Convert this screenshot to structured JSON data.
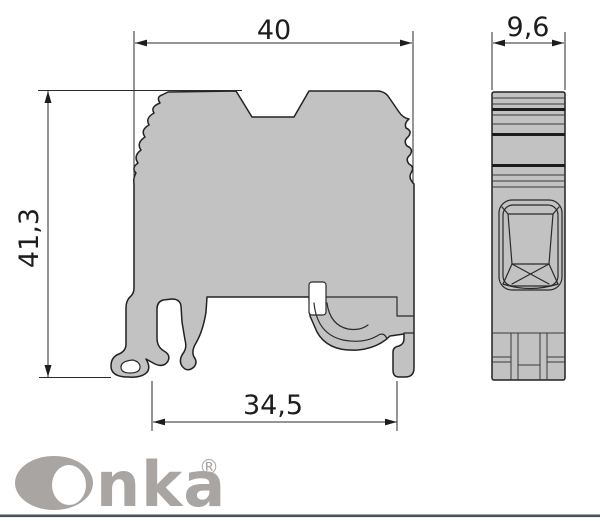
{
  "drawing": {
    "type_label": "terminal-block-dimension-drawing",
    "dims": {
      "width_top": "40",
      "height_left": "41,3",
      "width_bottom": "34,5",
      "depth_side": "9,6"
    }
  },
  "branding": {
    "logo_text": "Onka",
    "logo_tail": "nka",
    "registered": "®"
  },
  "colors": {
    "part_fill": "#c2c2c3",
    "outline": "#222222",
    "dimension_lines": "#2b2b2b",
    "logo_gray": "#a8a5a2",
    "footer_rule": "#4b5058",
    "background": "#ffffff"
  }
}
